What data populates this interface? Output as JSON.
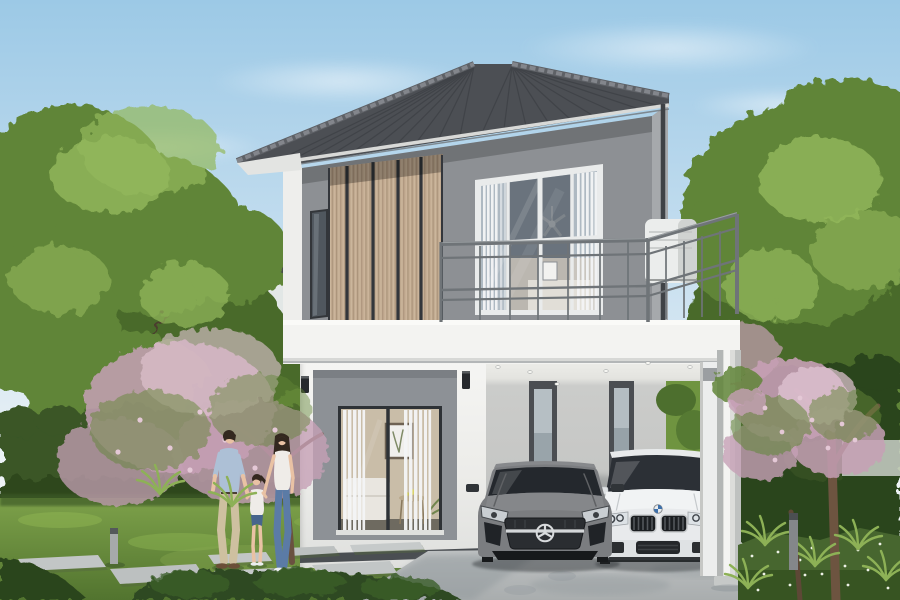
{
  "meta": {
    "title": "Architectural rendering of a modern two-storey house",
    "width_px": 900,
    "height_px": 600
  },
  "scene": {
    "description": "Daytime 3D architectural rendering: modern two-storey detached house with grey hipped tile roof, timber-slat feature wall, balcony with grey metal railing, ground-floor sliding glass door showing a living room, and an open carport with two parked cars; a family of three walks on a stepping-stone path in the landscaped garden",
    "sky": {
      "condition": "clear light blue with faint soft clouds"
    },
    "house": {
      "storeys": 2,
      "roof": "dark grey hipped concrete-tile roof with ribbed tiles and white gutter line",
      "upper_floor": {
        "features": [
          "tan vertical timber-slat feature panel with dark joint gaps",
          "narrow dark slot window",
          "four-pane white-framed sliding window",
          "ceiling fan and white curtains visible inside",
          "white air-conditioner unit on balcony",
          "dark rainwater downpipe at right corner"
        ]
      },
      "balcony": {
        "railing": "grey metal railing with twin top and bottom rails and slim vertical balusters, wrapping the right corner"
      },
      "ground_floor": {
        "features": [
          "grey recessed surround with dark-framed sliding glass door",
          "white sheer curtains",
          "living room visible: framed botanical print, white sofa, round coffee table with yellow flowers",
          "two black wall sconces",
          "dark plinth strip at wall base"
        ]
      },
      "carport": {
        "features": [
          "white header beam and ceiling with recessed downlights",
          "light grey rear wall with two narrow dark-framed slot windows",
          "open right bay showing garden greenery over a low white wall",
          "round white column on square base"
        ]
      }
    },
    "vehicles": [
      {
        "type": "sports coupe",
        "color": "grey",
        "grille_emblem": "three-pointed star in chrome ring",
        "position": "left bay of carport"
      },
      {
        "type": "sedan",
        "color": "white",
        "grille": "twin black kidney grilles",
        "grille_emblem": "blue-and-white roundel",
        "position": "right bay of carport"
      }
    ],
    "people": [
      {
        "role": "father",
        "outfit": "light-blue long-sleeve shirt, khaki trousers, brown shoes"
      },
      {
        "role": "daughter",
        "outfit": "white top, denim shorts, white shoes",
        "pose": "holding both parents' hands, looking up"
      },
      {
        "role": "mother",
        "outfit": "white short-sleeve top, blue skinny jeans, white sneakers"
      }
    ],
    "garden": {
      "elements": [
        "clipped green hedge on both sides",
        "pink flowering trees left and right",
        "large leafy green trees framing the scene",
        "ferns and ground cover with tiny white flowers",
        "concrete stepping-stone path across lawn",
        "two grey bollard lights",
        "neighbouring house with dark roof behind the trees",
        "concrete driveway with soft tree shadows"
      ]
    }
  },
  "palette": {
    "sky_top": "#9cc9e6",
    "sky_mid": "#c9e0f0",
    "sky_low": "#edf3f6",
    "roof_dark": "#3f4247",
    "roof_mid": "#585b61",
    "roof_ridge": "#83868c",
    "fascia": "#d8d9d7",
    "wall_grey": "#8d9094",
    "wall_grey_light": "#a6a9ac",
    "pillar_white": "#eeeeec",
    "slat": "#c2ab91",
    "slat_line": "#ab947b",
    "slat_gap": "#33363b",
    "frame_white": "#e9ebeb",
    "glass_blue": "#aeb9c2",
    "glass_dark": "#30353b",
    "curtain": "#f4f5f6",
    "white_wall": "#f1f1ef",
    "white_shade": "#d9dad8",
    "plinth": "#4a4e52",
    "rail_grey": "#6f7478",
    "carport_wall": "#c6c7c5",
    "carport_ceiling": "#ecece8",
    "window_frame_dark": "#4b4e52",
    "driveway": "#b3b6b7",
    "driveway_shadow": "#8e969a",
    "grass": "#72963f",
    "grass_dark": "#547631",
    "hedge": "#3a5626",
    "hedge_dark": "#2c441d",
    "leaf": "#618538",
    "leaf_light": "#93b85c",
    "leaf_deep": "#4a6b2b",
    "blossom": "#c6a0b5",
    "blossom_light": "#e4c8d6",
    "trunk": "#70563f",
    "stone": "#c2c6c6",
    "skin": "#e9c2a4",
    "hair": "#33281f",
    "shirt_blue": "#adc0d6",
    "khaki": "#cec0a0",
    "jeans": "#5b7ba6",
    "denim": "#47658c",
    "cloth_white": "#efece8",
    "mercedes_grey": "#7b7d80",
    "bmw_white": "#eceeef",
    "car_glass": "#24282d",
    "chrome": "#d4d7d9",
    "bmw_blue": "#3e70aa"
  }
}
